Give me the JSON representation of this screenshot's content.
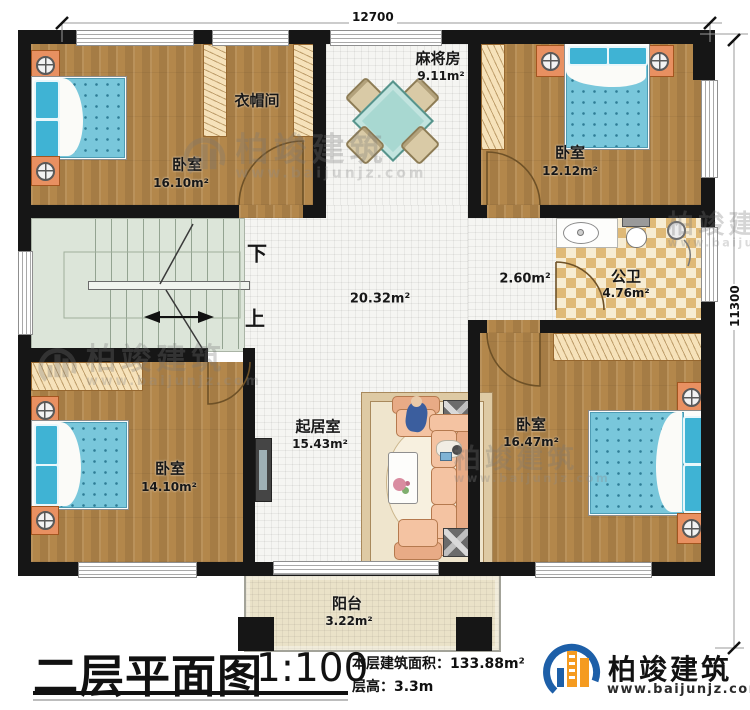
{
  "dimensions": {
    "top": "12700",
    "right": "11300"
  },
  "rooms": {
    "bedroom_tl": {
      "name": "卧室",
      "area": "16.10m²"
    },
    "cloakroom": {
      "name": "衣帽间"
    },
    "mahjong": {
      "name": "麻将房",
      "area": "9.11m²"
    },
    "bedroom_tr": {
      "name": "卧室",
      "area": "12.12m²"
    },
    "bathroom": {
      "name": "公卫",
      "area": "4.76m²"
    },
    "corridor": {
      "area": "2.60m²"
    },
    "hall": {
      "area": "20.32m²"
    },
    "living": {
      "name": "起居室",
      "area": "15.43m²"
    },
    "bedroom_bl": {
      "name": "卧室",
      "area": "14.10m²"
    },
    "bedroom_br": {
      "name": "卧室",
      "area": "16.47m²"
    },
    "balcony": {
      "name": "阳台",
      "area": "3.22m²"
    }
  },
  "stairs": {
    "down": "下",
    "up": "上"
  },
  "titleblock": {
    "title": "二层平面图",
    "scale": "1:100",
    "area_label": "本层建筑面积：",
    "area_value": "133.88m²",
    "floor_height_label": "层高：",
    "floor_height_value": "3.3m"
  },
  "brand": {
    "name": "柏竣建筑",
    "website": "www.baijunjz.com"
  },
  "watermark": {
    "name": "柏竣建筑",
    "website": "www.baijunjz.com"
  },
  "colors": {
    "wall": "#161616",
    "wood": "#b3874b",
    "tile": "#f5f5f2",
    "bed": "#79c7db",
    "stairs": "#dce5d9",
    "checker": "#dfb977",
    "balcony": "#eae2c8",
    "brand_blue": "#1d5fa8",
    "brand_orange": "#f59b20"
  }
}
